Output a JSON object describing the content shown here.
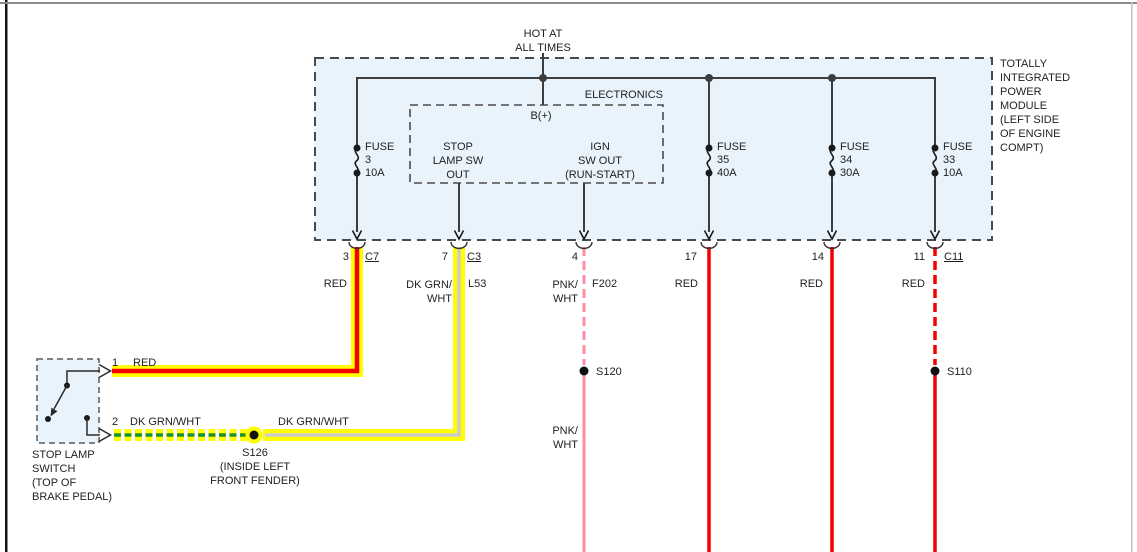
{
  "header": {
    "hot_at_line1": "HOT AT",
    "hot_at_line2": "ALL TIMES"
  },
  "tipm": {
    "label_lines": [
      "TOTALLY",
      "INTEGRATED",
      "POWER",
      "MODULE",
      "(LEFT SIDE",
      "OF ENGINE",
      "COMPT)"
    ],
    "electronics": {
      "label": "ELECTRONICS",
      "b_plus": "B(+)",
      "out1_lines": [
        "STOP",
        "LAMP SW",
        "OUT"
      ],
      "out2_lines": [
        "IGN",
        "SW OUT",
        "(RUN-START)"
      ]
    },
    "fuses": [
      {
        "label": "FUSE",
        "number": "3",
        "amps": "10A"
      },
      {
        "label": "FUSE",
        "number": "35",
        "amps": "40A"
      },
      {
        "label": "FUSE",
        "number": "34",
        "amps": "30A"
      },
      {
        "label": "FUSE",
        "number": "33",
        "amps": "10A"
      }
    ]
  },
  "pins": [
    {
      "pin": "3",
      "connector": "C7"
    },
    {
      "pin": "7",
      "connector": "C3"
    },
    {
      "pin": "4",
      "connector": ""
    },
    {
      "pin": "17",
      "connector": ""
    },
    {
      "pin": "14",
      "connector": ""
    },
    {
      "pin": "11",
      "connector": "C11"
    }
  ],
  "wires": {
    "w1": {
      "color": "RED"
    },
    "w2": {
      "color_line1": "DK GRN/",
      "color_line2": "WHT",
      "circuit": "L53"
    },
    "w3": {
      "color_line1": "PNK/",
      "color_line2": "WHT",
      "circuit": "F202",
      "color2_line1": "PNK/",
      "color2_line2": "WHT"
    },
    "w4": {
      "color": "RED"
    },
    "w5": {
      "color": "RED"
    },
    "w6": {
      "color": "RED"
    }
  },
  "splices": {
    "s120": "S120",
    "s110": "S110",
    "s126": {
      "name": "S126",
      "location_line1": "(INSIDE LEFT",
      "location_line2": "FRONT FENDER)"
    }
  },
  "stop_lamp_switch": {
    "pin1": "1",
    "pin1_wire": "RED",
    "pin2": "2",
    "pin2_wire_left": "DK GRN/WHT",
    "pin2_wire_right": "DK GRN/WHT",
    "label_lines": [
      "STOP LAMP",
      "SWITCH",
      "(TOP OF",
      "BRAKE PEDAL)"
    ]
  },
  "colors": {
    "wire_red": "#f40000",
    "wire_pink": "#ff8ea4",
    "wire_green": "#1f9126",
    "wire_white": "#cccccc",
    "highlight_yellow": "#ffff00",
    "module_fill": "#e9f3fb",
    "circuit_line": "#3d3d3d"
  }
}
